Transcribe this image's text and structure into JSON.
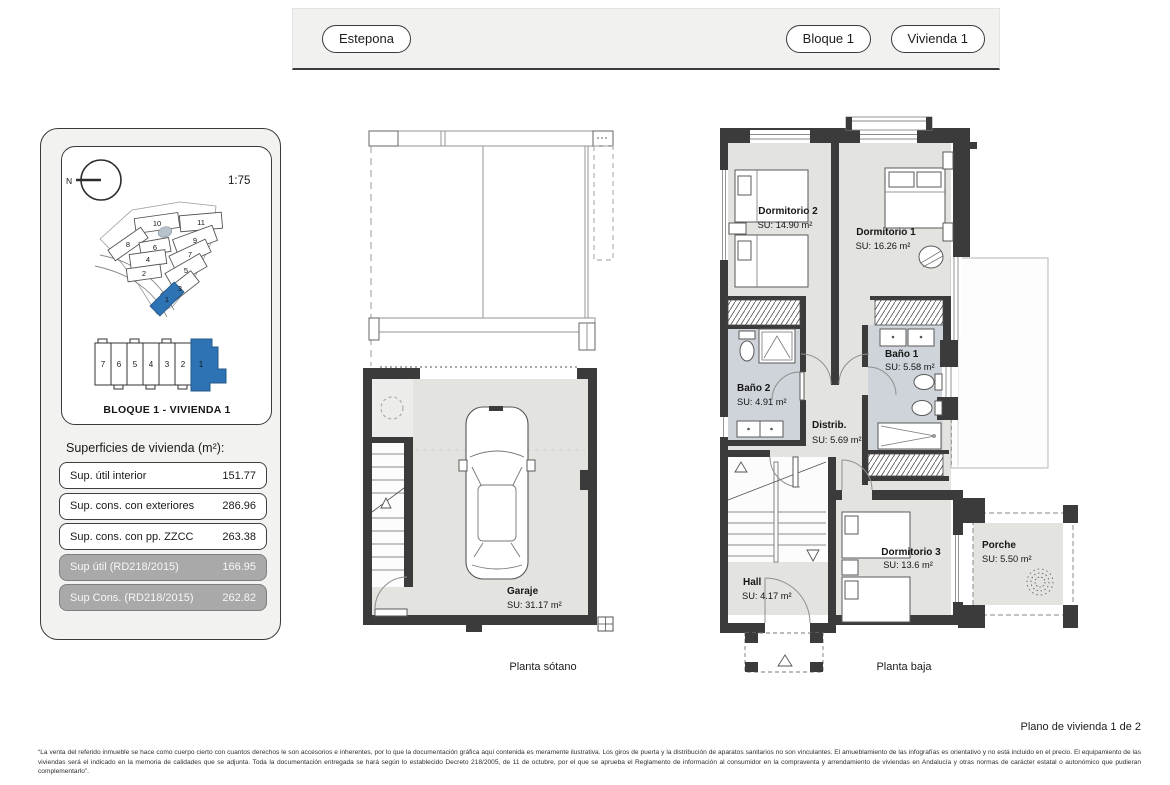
{
  "header": {
    "location_label": "Estepona",
    "block_label": "Bloque 1",
    "unit_label": "Vivienda 1"
  },
  "info_panel": {
    "compass_label": "N",
    "scale": "1:75",
    "site_map": {
      "plots": [
        "10",
        "11",
        "8",
        "6",
        "9",
        "7",
        "4",
        "5",
        "2",
        "3",
        "1"
      ],
      "selected_plot": "1"
    },
    "building_strip": {
      "units": [
        "7",
        "6",
        "5",
        "4",
        "3",
        "2",
        "1"
      ],
      "selected_unit": "1",
      "caption": "BLOQUE 1 - VIVIENDA 1"
    },
    "surfaces": {
      "title": "Superficies de vivienda (m²):",
      "rows": [
        {
          "label": "Sup. útil interior",
          "value": "151.77",
          "variant": "white"
        },
        {
          "label": "Sup. cons. con exteriores",
          "value": "286.96",
          "variant": "white"
        },
        {
          "label": "Sup. cons. con pp. ZZCC",
          "value": "263.38",
          "variant": "white"
        },
        {
          "label": "Sup útil (RD218/2015)",
          "value": "166.95",
          "variant": "gray"
        },
        {
          "label": "Sup Cons. (RD218/2015)",
          "value": "262.82",
          "variant": "gray"
        }
      ]
    }
  },
  "plans": {
    "basement": {
      "caption": "Planta sótano",
      "rooms": [
        {
          "name": "Garaje",
          "su": "SU: 31.17 m²"
        }
      ]
    },
    "ground": {
      "caption": "Planta baja",
      "rooms": [
        {
          "name": "Dormitorio 2",
          "su": "SU: 14.90 m²"
        },
        {
          "name": "Dormitorio 1",
          "su": "SU: 16.26 m²"
        },
        {
          "name": "Baño 2",
          "su": "SU: 4.91 m²"
        },
        {
          "name": "Baño 1",
          "su": "SU: 5.58 m²"
        },
        {
          "name": "Distrib.",
          "su": "SU: 5.69 m²"
        },
        {
          "name": "Hall",
          "su": "SU: 4.17 m²"
        },
        {
          "name": "Dormitorio 3",
          "su": "SU: 13.6 m²"
        },
        {
          "name": "Porche",
          "su": "SU: 5.50 m²"
        }
      ]
    }
  },
  "footer": {
    "page_label": "Plano de vivienda 1 de 2",
    "disclaimer": "“La venta del referido inmueble se hace como cuerpo cierto con cuantos derechos le son accesorios e inherentes, por lo que la documentación gráfica aquí contenida es meramente ilustrativa. Los giros de puerta y la distribución de aparatos sanitarios no son vinculantes. El amueblamiento de las infografías es orientativo y no está incluido en el precio. El equipamiento de las viviendas será el indicado en la memoria de calidades que se adjunta. Toda la documentación entregada se hará según lo establecido Decreto 218/2005, de 11 de octubre, por el que se aprueba el Reglamento de información al consumidor en la compraventa y arrendamiento de viviendas en Andalucía y otras normas de carácter estatal o autonómico que pudieran complementarlo”."
  },
  "colors": {
    "accent_blue": "#2e74b5",
    "wall_dark": "#3b3b3b",
    "floor_gray": "#e3e3e0",
    "bath_floor": "#ced4da",
    "row_gray": "#a9a9a9",
    "header_gray": "#f1f1f0"
  }
}
